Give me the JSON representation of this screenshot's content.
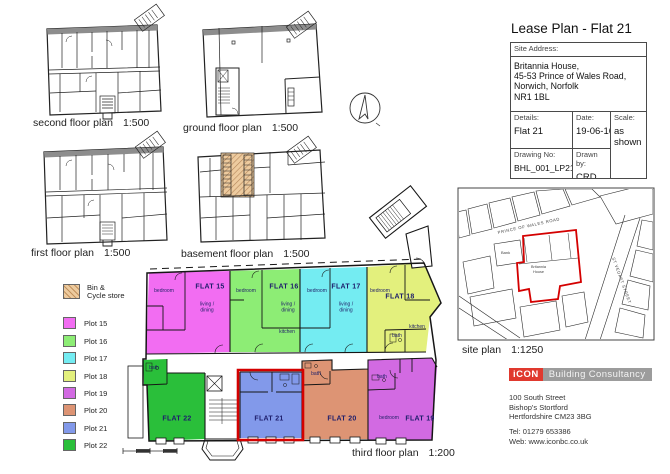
{
  "page": {
    "accent_red": "#d40000"
  },
  "title_block": {
    "title": "Lease Plan - Flat 21",
    "site_address_label": "Site Address:",
    "site_address": "Britannia House,\n45-53 Prince of Wales Road,\nNorwich, Norfolk\nNR1 1BL",
    "details_label": "Details:",
    "details_value": "Flat 21",
    "date_label": "Date:",
    "date_value": "19-06-16",
    "scale_label": "Scale:",
    "scale_value": "as shown",
    "drawing_no_label": "Drawing No:",
    "drawing_no_value": "BHL_001_LP21",
    "drawn_by_label": "Drawn by:",
    "drawn_by_value": "CRD"
  },
  "captions": {
    "second_floor": {
      "name": "second floor plan",
      "scale": "1:500"
    },
    "ground_floor": {
      "name": "ground floor plan",
      "scale": "1:500"
    },
    "first_floor": {
      "name": "first floor plan",
      "scale": "1:500"
    },
    "basement": {
      "name": "basement floor plan",
      "scale": "1:500"
    },
    "third_floor": {
      "name": "third floor plan",
      "scale": "1:200"
    },
    "site_plan": {
      "name": "site plan",
      "scale": "1:1250"
    }
  },
  "legend": {
    "bin": {
      "label": "Bin &\nCycle store",
      "color": "#edcb9f"
    },
    "plots": [
      {
        "label": "Plot 15",
        "color": "#f26df2",
        "y": 317
      },
      {
        "label": "Plot 16",
        "color": "#8ded75",
        "y": 335
      },
      {
        "label": "Plot 17",
        "color": "#74ecf2",
        "y": 352
      },
      {
        "label": "Plot 18",
        "color": "#e3f07d",
        "y": 370
      },
      {
        "label": "Plot 19",
        "color": "#d26ae2",
        "y": 387
      },
      {
        "label": "Plot 20",
        "color": "#dd9474",
        "y": 404
      },
      {
        "label": "Plot 21",
        "color": "#8299ea",
        "y": 422
      },
      {
        "label": "Plot 22",
        "color": "#2abf3a",
        "y": 439
      }
    ]
  },
  "third_floor": {
    "flats": [
      {
        "name": "FLAT 15",
        "color": "#f26df2",
        "x": 210,
        "y": 287
      },
      {
        "name": "FLAT 16",
        "color": "#8ded75",
        "x": 284,
        "y": 287
      },
      {
        "name": "FLAT 17",
        "color": "#74ecf2",
        "x": 346,
        "y": 287
      },
      {
        "name": "FLAT 18",
        "color": "#e3f07d",
        "x": 400,
        "y": 297
      },
      {
        "name": "FLAT 19",
        "color": "#d26ae2",
        "x": 420,
        "y": 419
      },
      {
        "name": "FLAT 20",
        "color": "#dd9474",
        "x": 342,
        "y": 419
      },
      {
        "name": "FLAT 21",
        "color": "#8299ea",
        "x": 269,
        "y": 419
      },
      {
        "name": "FLAT 22",
        "color": "#2abf3a",
        "x": 177,
        "y": 419
      }
    ],
    "rooms": [
      {
        "text": "bedroom",
        "x": 164,
        "y": 292
      },
      {
        "text": "living /\ndining",
        "x": 207,
        "y": 308
      },
      {
        "text": "bedroom",
        "x": 246,
        "y": 292
      },
      {
        "text": "living /\ndining",
        "x": 288,
        "y": 308
      },
      {
        "text": "kitchen",
        "x": 287,
        "y": 333
      },
      {
        "text": "bedroom",
        "x": 317,
        "y": 292
      },
      {
        "text": "living /\ndining",
        "x": 346,
        "y": 308
      },
      {
        "text": "bedroom",
        "x": 380,
        "y": 292
      },
      {
        "text": "kitchen",
        "x": 417,
        "y": 328
      },
      {
        "text": "bath",
        "x": 397,
        "y": 337
      },
      {
        "text": "bath",
        "x": 154,
        "y": 369
      },
      {
        "text": "bath",
        "x": 316,
        "y": 375
      },
      {
        "text": "bath",
        "x": 382,
        "y": 378
      },
      {
        "text": "bedroom",
        "x": 389,
        "y": 419
      }
    ]
  },
  "site_plan": {
    "road_label": "PRINCE OF WALES ROAD",
    "building_label_1": "Britannia",
    "building_label_2": "House",
    "bank_label": "Bank",
    "street_label": "ST VEDAST STREET"
  },
  "branding": {
    "logo_icon_text": "iCON",
    "logo_text": "Building Consultancy",
    "logo_red": "#e0392e",
    "logo_gray": "#9c9c9c",
    "address": "100 South Street\nBishop's Stortford\nHertfordshire CM23 3BG",
    "contact": "Tel: 01279 653386\nWeb: www.iconbc.co.uk"
  }
}
